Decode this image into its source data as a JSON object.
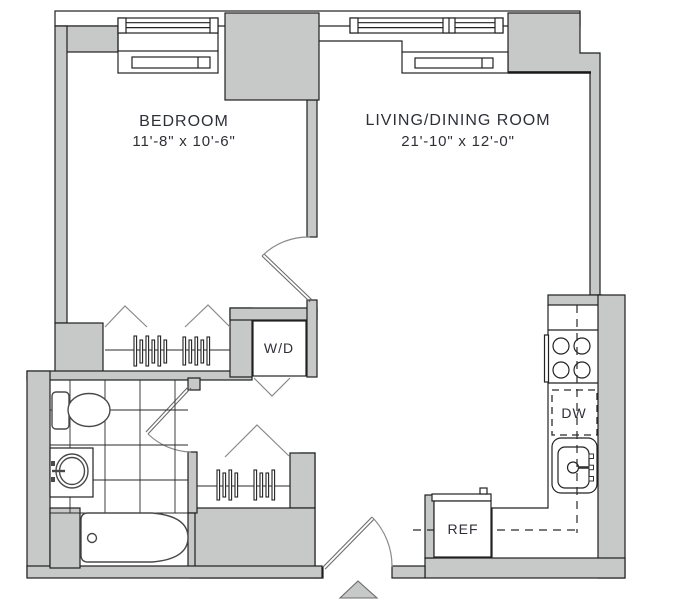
{
  "rooms": [
    {
      "name": "BEDROOM",
      "dimensions": "11'-8\" x 10'-6\""
    },
    {
      "name": "LIVING/DINING ROOM",
      "dimensions": "21'-10\" x 12'-0\""
    }
  ],
  "labels": {
    "washer_dryer": "W/D",
    "dishwasher": "DW",
    "refrigerator": "REF"
  },
  "colors": {
    "wall_fill": "#c6c9c8",
    "wall_outline": "#1f1f1f",
    "fixture_outline": "#222222",
    "swing_line": "#8a8a8a",
    "label_text": "#2e3038",
    "background": "#ffffff"
  }
}
